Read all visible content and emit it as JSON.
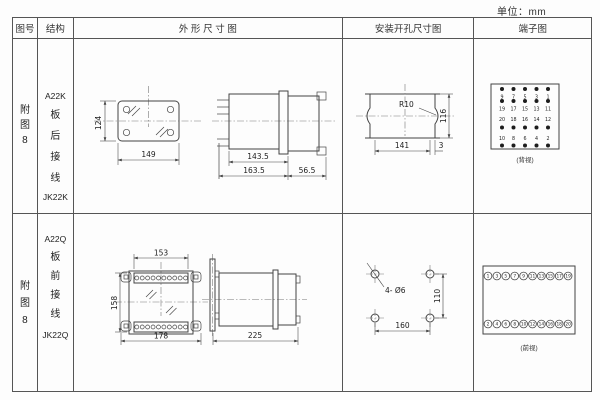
{
  "unit_label": "单位：mm",
  "header": {
    "fig_no": "图号",
    "structure": "结构",
    "outline": "外 形 尺 寸 图",
    "install": "安装开孔尺寸图",
    "terminal": "端子图"
  },
  "rows": [
    {
      "fig_no": {
        "c0": "附",
        "c1": "图",
        "c2": "8"
      },
      "structure": {
        "model": "A22K",
        "c0": "板",
        "c1": "后",
        "c2": "接",
        "c3": "线",
        "code": "JK22K"
      },
      "outline": {
        "front_height": "124",
        "front_width": "149",
        "depth_inner": "143.5",
        "depth_outer": "163.5",
        "rear_depth": "56.5"
      },
      "install": {
        "radius_label": "R10",
        "hole_width": "141",
        "hole_height": "116",
        "edge_offset": "3"
      },
      "terminal": {
        "caption": "(背视)",
        "dot_rows": [
          {
            "pos": "below",
            "numbers": [
              "9",
              "7",
              "5",
              "3",
              "1"
            ]
          },
          {
            "pos": "below",
            "numbers": [
              "19",
              "17",
              "15",
              "13",
              "11"
            ]
          },
          {
            "pos": "above",
            "numbers": [
              "20",
              "18",
              "16",
              "14",
              "12"
            ]
          },
          {
            "pos": "above",
            "numbers": [
              "10",
              "8",
              "6",
              "4",
              "2"
            ]
          }
        ]
      }
    },
    {
      "fig_no": {
        "c0": "附",
        "c1": "图",
        "c2": "8"
      },
      "structure": {
        "model": "A22Q",
        "c0": "板",
        "c1": "前",
        "c2": "接",
        "c3": "线",
        "code": "JK22Q"
      },
      "outline": {
        "strip_width": "153",
        "front_height": "158",
        "front_width": "178",
        "depth": "225"
      },
      "install": {
        "holes_label": "4- Ø6",
        "hole_height": "110",
        "hole_width": "160"
      },
      "terminal": {
        "caption": "(前视)",
        "top_numbers": [
          "1",
          "3",
          "5",
          "7",
          "9",
          "11",
          "13",
          "15",
          "17",
          "19"
        ],
        "bottom_numbers": [
          "2",
          "4",
          "6",
          "8",
          "10",
          "12",
          "14",
          "16",
          "18",
          "20"
        ]
      }
    }
  ],
  "colors": {
    "line": "#444444",
    "text": "#222222",
    "background": "#fdfdfd"
  }
}
